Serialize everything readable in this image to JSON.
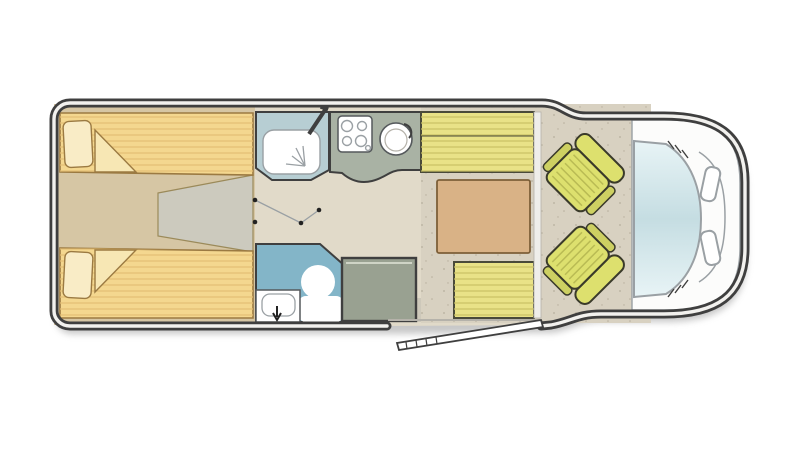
{
  "figure_label": "Motorhome floor plan with rear twin beds, central washroom, kitchen, dinette and driver cab",
  "rooms": {
    "rear_bedroom": "rear-twin-bedroom",
    "shower": "shower-cubicle",
    "washroom": "toilet-washroom",
    "kitchen": "kitchen-block",
    "wardrobe": "wardrobe",
    "dinette": "dinette-lounge",
    "cab": "driver-cab"
  },
  "palette": {
    "page_bg": "#ffffff",
    "wall_dark": "#3f3f3f",
    "wall_inner": "#f2f1ee",
    "shadow": "#9a9a9a",
    "floor_bedroom": "#d6c6a4",
    "floor_corridor": "#e1dac9",
    "floor_dinette": "#d8d1c1",
    "floor_speckle": "#b6ae9c",
    "entry_floor": "#cdc8ba",
    "step_gray": "#cccabe",
    "step_edge": "#9b8a5a",
    "bed_fill": "#f4d78f",
    "bed_stripe": "#e4be74",
    "bed_outline": "#9b7a42",
    "pillow_fill": "#f9ecc6",
    "blanket_fill": "#f7e7b4",
    "shower_fill": "#b7ced3",
    "toilet_room_fill": "#83b5c8",
    "fixture_white": "#ffffff",
    "fixture_outline": "#55595c",
    "kitchen_counter": "#a9b2a4",
    "wardrobe_fill": "#99a191",
    "wardrobe_highlight": "#cfd4c6",
    "bench_fill": "#e9e287",
    "bench_stripe": "#c9c163",
    "bench_outline": "#4a4a3a",
    "table_fill": "#d9b286",
    "table_outline": "#7d5f38",
    "seat_fill": "#dde06e",
    "seat_arm": "#cdd062",
    "seat_stripe": "#b9bb54",
    "seat_outline": "#3a3a2a",
    "cab_white": "#fcfcfb",
    "cab_line": "#9aa0a4",
    "glass_light": "#e8f4f6",
    "glass_mid": "#c5dde2",
    "door_dark": "#3f3f3f",
    "door_fill": "#ffffff",
    "pivot_dot": "#222222",
    "window_band": "#efeeea",
    "window_edge": "#b5b2aa"
  }
}
